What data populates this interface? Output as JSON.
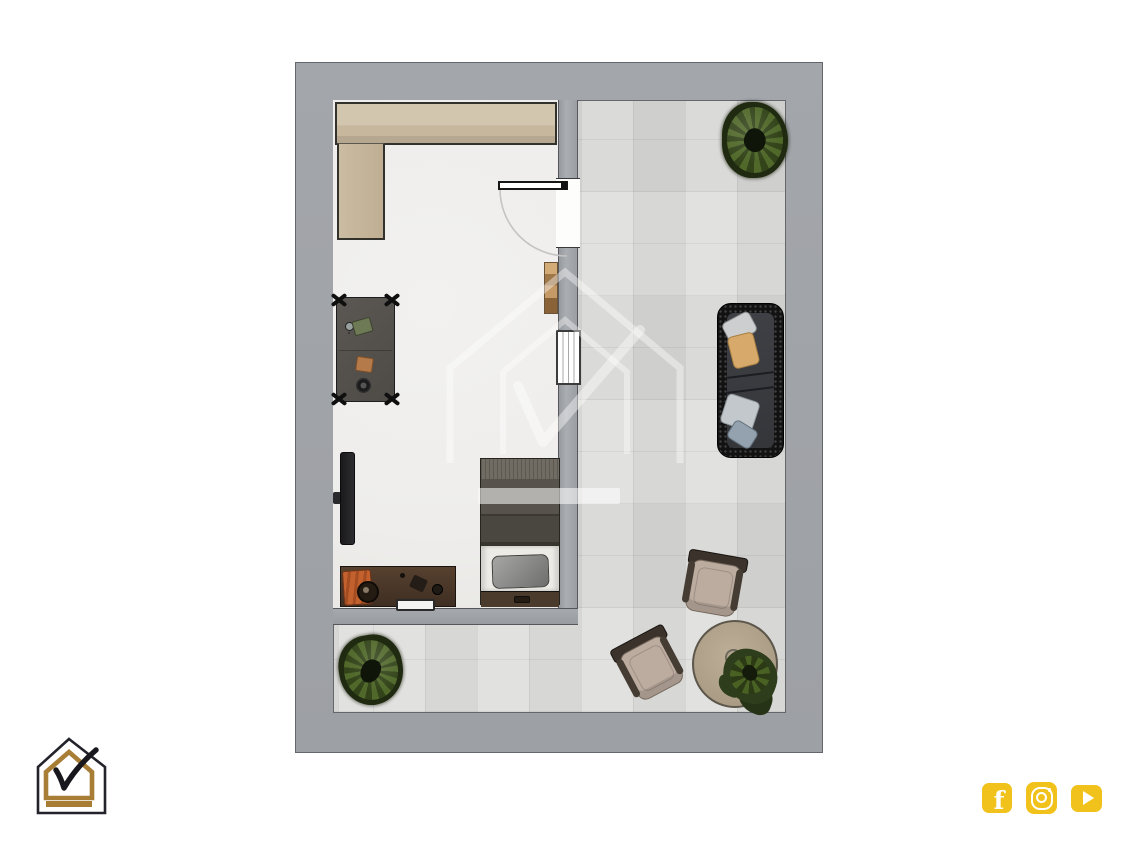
{
  "page": {
    "background": "#ffffff",
    "content_type": "top-down 3d floor plan rendering, no visible text"
  },
  "palette": {
    "wall_gray": "#a0a3a8",
    "wall_edge": "#55575b",
    "terrace_tile": "#d8d8d6",
    "bedroom_floor": "#efeeec",
    "wardrobe_beige": "#c9bba3",
    "wood_brown": "#4a382c",
    "sofa_charcoal": "#141414",
    "plant_green": "#3f5522",
    "logo_gold": "#a87e36",
    "logo_outline": "#23232b",
    "social_yellow": "#f1c21b",
    "watermark_white": "rgba(255,255,255,0.4)"
  },
  "plan": {
    "rooms": [
      {
        "id": "bedroom",
        "floor": "light parquet white"
      },
      {
        "id": "terrace",
        "floor": "gray stone tiles, L-shaped around bedroom"
      }
    ],
    "bedroom_items": [
      "l-shaped-wardrobe",
      "wall-shelf",
      "side-table-with-accessories",
      "wall-mounted-tv",
      "sideboard-console-with-bag-and-speaker",
      "single-bed-with-pillow",
      "entry-door-with-swing-arc",
      "window-in-partition-wall"
    ],
    "terrace_items": [
      "round-bush-plant-top",
      "outdoor-sofa-with-four-cushions",
      "armchair-upper",
      "armchair-lower",
      "round-table-with-plant",
      "round-bush-plant-bottom"
    ]
  },
  "branding": {
    "watermark_icon": "house-checkmark-watermark",
    "logo_icon": "house-checkmark-logo"
  },
  "social": {
    "accent": "#f1c21b",
    "links": [
      {
        "icon": "facebook-icon",
        "label": "Facebook"
      },
      {
        "icon": "instagram-icon",
        "label": "Instagram"
      },
      {
        "icon": "youtube-icon",
        "label": "YouTube"
      }
    ]
  }
}
